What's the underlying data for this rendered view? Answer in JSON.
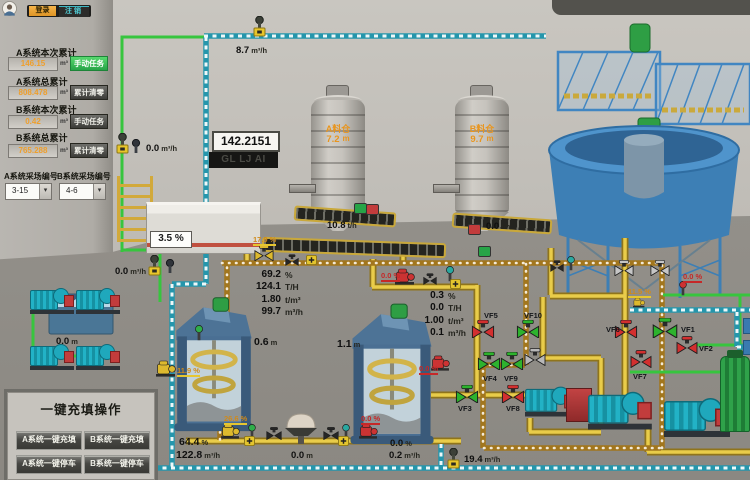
{
  "auth": {
    "login": "登录",
    "logout": "注销"
  },
  "ui": {
    "select_arrow": "▾"
  },
  "accumulators": [
    {
      "label": "A系统本次累计",
      "value": "146.15",
      "unit": "m³",
      "action": "手动任务"
    },
    {
      "label": "A系统总累计",
      "value": "808.478",
      "unit": "m³",
      "action": "累计清零"
    },
    {
      "label": "B系统本次累计",
      "value": "0.42",
      "unit": "m³",
      "action": "手动任务"
    },
    {
      "label": "B系统总累计",
      "value": "765.288",
      "unit": "m³",
      "action": "累计清零"
    }
  ],
  "site_selectors": [
    {
      "label": "A系统采场编号",
      "value": "3-15"
    },
    {
      "label": "B系统采场编号",
      "value": "4-6"
    }
  ],
  "onekey": {
    "title": "一键充填操作",
    "buttons": [
      "A系统一键充填",
      "B系统一键充填",
      "A系统一键停车",
      "B系统一键停车"
    ]
  },
  "counter": {
    "value": "142.2151",
    "code": "GL LJ AI ACC"
  },
  "silos": [
    {
      "name": "A料仓",
      "level": "7.2",
      "level_unit": "m",
      "feed": "10.8",
      "feed_unit": "t/h"
    },
    {
      "name": "B料仓",
      "level": "9.7",
      "level_unit": "m",
      "feed": "0.0",
      "feed_unit": "t/h"
    }
  ],
  "mixers": [
    {
      "level": "0.6",
      "unit": "m"
    },
    {
      "level": "1.1",
      "unit": "m"
    }
  ],
  "slurry": [
    {
      "pct": "69.2",
      "pct_u": "%",
      "tph": "124.1",
      "tph_u": "T/H",
      "den": "1.80",
      "den_u": "t/m³",
      "flow": "99.7",
      "flow_u": "m³/h"
    },
    {
      "pct": "0.3",
      "pct_u": "%",
      "tph": "0.0",
      "tph_u": "T/H",
      "den": "1.00",
      "den_u": "t/m³",
      "flow": "0.1",
      "flow_u": "m³/h"
    }
  ],
  "readouts": {
    "top_flow": {
      "value": "8.7",
      "unit": "m³/h"
    },
    "left_flow": {
      "value": "0.0",
      "unit": "m³/h"
    },
    "tank_flow": {
      "value": "0.0",
      "unit": "m³/h"
    },
    "floc_level": "3.5 %",
    "water_tank": {
      "value": "0.0",
      "unit": "m"
    },
    "hopper": {
      "value": "0.0",
      "unit": "m"
    },
    "fill_a": {
      "pct": "64.4",
      "pct_u": "%",
      "flow": "122.8",
      "flow_u": "m³/h"
    },
    "fill_b": {
      "pct": "0.0",
      "pct_u": "%",
      "flow": "0.2",
      "flow_u": "m³/h"
    },
    "return_flow": {
      "value": "19.4",
      "unit": "m³/h"
    }
  },
  "valve_openings": {
    "feed_valve": "17.9 %",
    "mixer1_inlet": "11.9 %",
    "discharge_a": "26.6 %",
    "discharge_b": "0.0 %",
    "mixer2_feed": "0.0 %",
    "mixer2_drain": "0.0 %",
    "thickener_right": "0.0 %",
    "thickener_under": "11.5 %"
  },
  "valves": {
    "vf1": "VF1",
    "vf2": "VF2",
    "vf3": "VF3",
    "vf4": "VF4",
    "vf5": "VF5",
    "vf6": "VF6",
    "vf7": "VF7",
    "vf8": "VF8",
    "vf9": "VF9",
    "vf10": "VF10"
  },
  "colors": {
    "water_pipe": "#2596ac",
    "slurry_pipe": "#a2761d",
    "fill_pipe": "#e9cc4a",
    "green_pipe": "#37c53e",
    "valve_open": "#2db32d",
    "valve_closed": "#d32f2f",
    "accent_orange": "#ef9f2c"
  }
}
